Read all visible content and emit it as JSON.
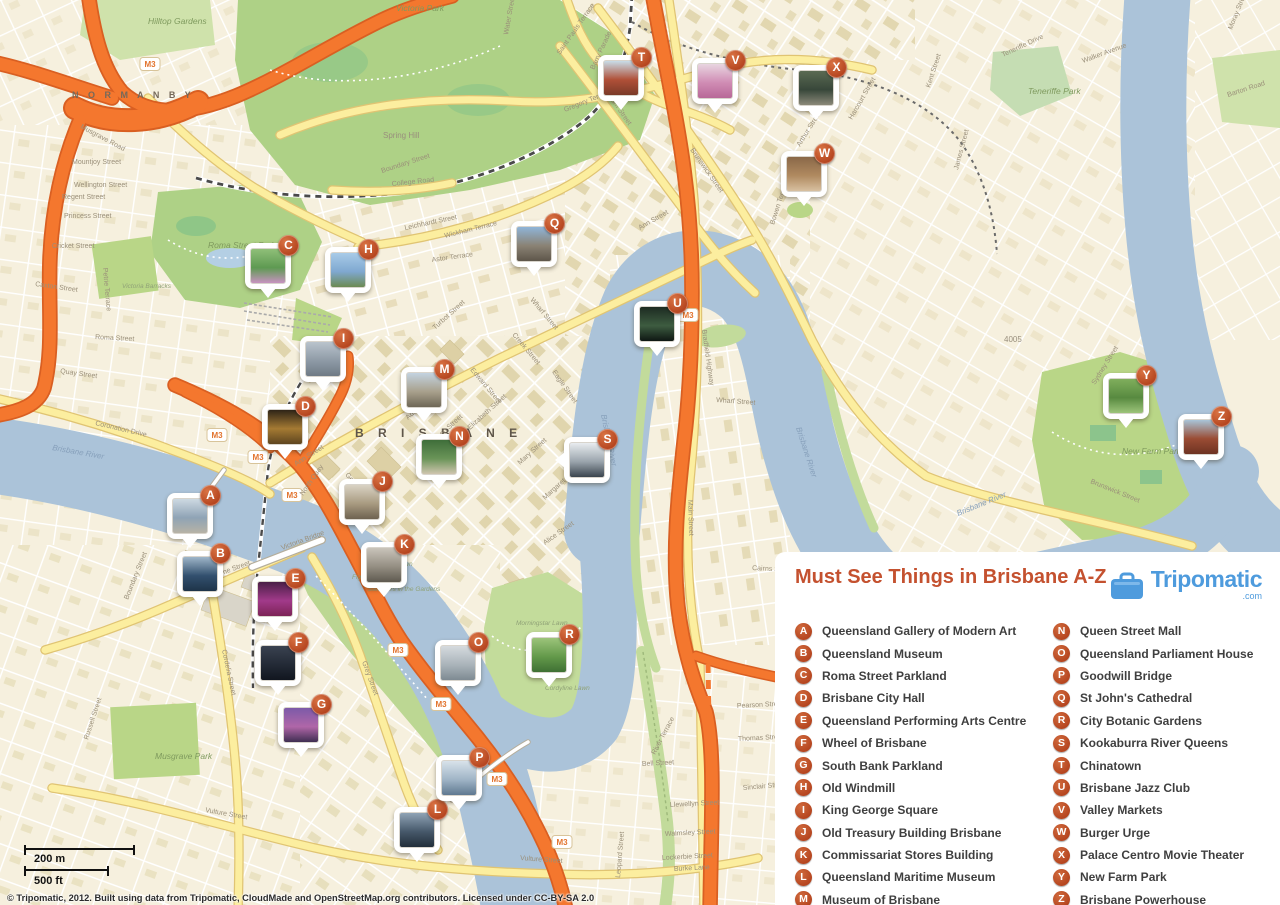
{
  "colors": {
    "water": "#abc3d9",
    "land": "#f6f0de",
    "park": "#b9d687",
    "motorway": "#f4772e",
    "road_yellow": "#fcee9f",
    "badge_orange": "#bf4f27",
    "title_orange": "#c4512f",
    "brand_blue": "#4e9bdd"
  },
  "legend": {
    "title": "Must See Things in Brisbane A-Z",
    "brand": {
      "name": "Tripomatic",
      "tld": ".com"
    },
    "items": [
      {
        "letter": "A",
        "label": "Queensland Gallery of Modern Art"
      },
      {
        "letter": "B",
        "label": "Queensland Museum"
      },
      {
        "letter": "C",
        "label": "Roma Street Parkland"
      },
      {
        "letter": "D",
        "label": "Brisbane City Hall"
      },
      {
        "letter": "E",
        "label": "Queensland Performing Arts Centre"
      },
      {
        "letter": "F",
        "label": "Wheel of Brisbane"
      },
      {
        "letter": "G",
        "label": "South Bank Parkland"
      },
      {
        "letter": "H",
        "label": "Old Windmill"
      },
      {
        "letter": "I",
        "label": "King George Square"
      },
      {
        "letter": "J",
        "label": "Old Treasury Building Brisbane"
      },
      {
        "letter": "K",
        "label": "Commissariat Stores Building"
      },
      {
        "letter": "L",
        "label": "Queensland Maritime Museum"
      },
      {
        "letter": "M",
        "label": "Museum of Brisbane"
      },
      {
        "letter": "N",
        "label": "Queen Street Mall"
      },
      {
        "letter": "O",
        "label": "Queensland Parliament House"
      },
      {
        "letter": "P",
        "label": "Goodwill Bridge"
      },
      {
        "letter": "Q",
        "label": "St John's Cathedral"
      },
      {
        "letter": "R",
        "label": "City Botanic Gardens"
      },
      {
        "letter": "S",
        "label": "Kookaburra River Queens"
      },
      {
        "letter": "T",
        "label": "Chinatown"
      },
      {
        "letter": "U",
        "label": "Brisbane Jazz Club"
      },
      {
        "letter": "V",
        "label": "Valley Markets"
      },
      {
        "letter": "W",
        "label": "Burger Urge"
      },
      {
        "letter": "X",
        "label": "Palace Centro Movie Theater"
      },
      {
        "letter": "Y",
        "label": "New Farm Park"
      },
      {
        "letter": "Z",
        "label": "Brisbane Powerhouse"
      }
    ]
  },
  "markers": [
    {
      "letter": "A",
      "x": 190,
      "y": 516,
      "tail": "b",
      "photo": [
        "#cdd9e2",
        "#8fa3b5",
        "#b7b2a6"
      ]
    },
    {
      "letter": "B",
      "x": 200,
      "y": 574,
      "tail": "b",
      "photo": [
        "#9fb6c9",
        "#32506e",
        "#1e3348"
      ]
    },
    {
      "letter": "C",
      "x": 268,
      "y": 266,
      "tail": "b",
      "photo": [
        "#8fbf78",
        "#5e9a52",
        "#c793c0"
      ]
    },
    {
      "letter": "D",
      "x": 285,
      "y": 427,
      "tail": "b",
      "photo": [
        "#2e2417",
        "#a57a33",
        "#5e451f"
      ]
    },
    {
      "letter": "E",
      "x": 275,
      "y": 599,
      "tail": "b",
      "photo": [
        "#4a1f47",
        "#a13a8a",
        "#7c2356"
      ]
    },
    {
      "letter": "F",
      "x": 278,
      "y": 663,
      "tail": "b",
      "photo": [
        "#3a4250",
        "#232a36",
        "#11161f"
      ]
    },
    {
      "letter": "G",
      "x": 301,
      "y": 725,
      "tail": "b",
      "photo": [
        "#7c5aa8",
        "#b066a8",
        "#3f2e52"
      ]
    },
    {
      "letter": "H",
      "x": 348,
      "y": 270,
      "tail": "b",
      "photo": [
        "#a8cbe8",
        "#7fa8d0",
        "#6c8a52"
      ]
    },
    {
      "letter": "I",
      "x": 323,
      "y": 359,
      "tail": "b",
      "photo": [
        "#b9c3cc",
        "#8e9aa6",
        "#6f7a85"
      ]
    },
    {
      "letter": "J",
      "x": 362,
      "y": 502,
      "tail": "b",
      "photo": [
        "#d9d2c4",
        "#a89a80",
        "#6e6250"
      ]
    },
    {
      "letter": "K",
      "x": 384,
      "y": 565,
      "tail": "b",
      "photo": [
        "#c9c4ba",
        "#948e82",
        "#5f5a50"
      ]
    },
    {
      "letter": "L",
      "x": 417,
      "y": 830,
      "tail": "b",
      "photo": [
        "#8fa3b5",
        "#46586a",
        "#222e3a"
      ]
    },
    {
      "letter": "M",
      "x": 424,
      "y": 390,
      "tail": "b",
      "photo": [
        "#c3d2e0",
        "#a8a08c",
        "#6e6756"
      ]
    },
    {
      "letter": "N",
      "x": 439,
      "y": 457,
      "tail": "b",
      "photo": [
        "#3f6e3a",
        "#6a9458",
        "#cfc5ae"
      ]
    },
    {
      "letter": "O",
      "x": 458,
      "y": 663,
      "tail": "b",
      "photo": [
        "#d5dade",
        "#aab4ba",
        "#7e8a92"
      ]
    },
    {
      "letter": "P",
      "x": 459,
      "y": 778,
      "tail": "b",
      "photo": [
        "#d8e2ea",
        "#9fb4c6",
        "#5f7890"
      ]
    },
    {
      "letter": "Q",
      "x": 534,
      "y": 244,
      "tail": "b",
      "photo": [
        "#8fb4d8",
        "#8a8274",
        "#5e564a"
      ]
    },
    {
      "letter": "R",
      "x": 549,
      "y": 655,
      "tail": "b",
      "photo": [
        "#9cc47a",
        "#63994a",
        "#3f7034"
      ]
    },
    {
      "letter": "S",
      "x": 587,
      "y": 460,
      "tail": "l",
      "photo": [
        "#e8ecef",
        "#9aa4ac",
        "#3a444e"
      ]
    },
    {
      "letter": "T",
      "x": 621,
      "y": 78,
      "tail": "b",
      "photo": [
        "#c8dce8",
        "#b05038",
        "#7a3a28"
      ]
    },
    {
      "letter": "U",
      "x": 657,
      "y": 324,
      "tail": "b",
      "photo": [
        "#1d2b22",
        "#3d5c40",
        "#0e1713"
      ]
    },
    {
      "letter": "V",
      "x": 715,
      "y": 81,
      "tail": "b",
      "photo": [
        "#e8d5e0",
        "#d08cb4",
        "#b86898"
      ]
    },
    {
      "letter": "W",
      "x": 804,
      "y": 174,
      "tail": "b",
      "photo": [
        "#8a6848",
        "#b08a60",
        "#d8c0a0"
      ]
    },
    {
      "letter": "X",
      "x": 816,
      "y": 88,
      "tail": "b",
      "photo": [
        "#5a6a52",
        "#38473a",
        "#8a8878"
      ]
    },
    {
      "letter": "Y",
      "x": 1126,
      "y": 396,
      "tail": "b",
      "photo": [
        "#7fae5c",
        "#588a40",
        "#9cc47a"
      ]
    },
    {
      "letter": "Z",
      "x": 1201,
      "y": 437,
      "tail": "b",
      "photo": [
        "#a8c4d8",
        "#9a4c34",
        "#6e3322"
      ]
    }
  ],
  "map_labels": {
    "places": [
      {
        "t": "N O R M A N B Y",
        "x": 72,
        "y": 98,
        "cls": "lbl-suburb"
      },
      {
        "t": "B R I S B A N E",
        "x": 355,
        "y": 437,
        "cls": "lbl-suburb-lg"
      },
      {
        "t": "Spring Hill",
        "x": 383,
        "y": 138,
        "cls": "lbl-suburb-sm"
      },
      {
        "t": "4005",
        "x": 1004,
        "y": 342,
        "cls": "lbl-suburb-sm"
      },
      {
        "t": "Victoria Park",
        "x": 396,
        "y": 11,
        "cls": "lbl-park"
      },
      {
        "t": "Hilltop Gardens",
        "x": 148,
        "y": 24,
        "cls": "lbl-park"
      },
      {
        "t": "Roma Street Park",
        "x": 208,
        "y": 248,
        "cls": "lbl-park"
      },
      {
        "t": "Victoria Barracks",
        "x": 122,
        "y": 288,
        "cls": "lbl-park-sm"
      },
      {
        "t": "Musgrave Park",
        "x": 155,
        "y": 759,
        "cls": "lbl-park"
      },
      {
        "t": "New Farm Park",
        "x": 1122,
        "y": 454,
        "cls": "lbl-park"
      },
      {
        "t": "Teneriffe Park",
        "x": 1028,
        "y": 94,
        "cls": "lbl-park"
      },
      {
        "t": "Royal Palm Lawn",
        "x": 362,
        "y": 566,
        "cls": "lbl-park-sm"
      },
      {
        "t": "Fig Tree Avenue",
        "x": 352,
        "y": 579,
        "cls": "lbl-park-sm"
      },
      {
        "t": "Steamers in the Gardens",
        "x": 368,
        "y": 591,
        "cls": "lbl-park-sm"
      },
      {
        "t": "Morningstar Lawn",
        "x": 516,
        "y": 625,
        "cls": "lbl-park-sm"
      },
      {
        "t": "Cordyline Lawn",
        "x": 545,
        "y": 690,
        "cls": "lbl-park-sm"
      }
    ],
    "rivers": [
      {
        "t": "Brisbane River",
        "x": 52,
        "y": 450,
        "rot": 10
      },
      {
        "t": "Brisbane River",
        "x": 601,
        "y": 415,
        "rot": 78
      },
      {
        "t": "Brisbane River",
        "x": 796,
        "y": 428,
        "rot": 72
      },
      {
        "t": "Brisbane River",
        "x": 958,
        "y": 516,
        "rot": -22
      }
    ],
    "streets": [
      {
        "t": "Gregory Terrace",
        "x": 565,
        "y": 112,
        "rot": -22
      },
      {
        "t": "College Road",
        "x": 392,
        "y": 186,
        "rot": -6
      },
      {
        "t": "Wickham Terrace",
        "x": 445,
        "y": 238,
        "rot": -14
      },
      {
        "t": "Boundary Street",
        "x": 382,
        "y": 173,
        "rot": -18
      },
      {
        "t": "Leichhardt Street",
        "x": 405,
        "y": 230,
        "rot": -12
      },
      {
        "t": "Astor Terrace",
        "x": 432,
        "y": 262,
        "rot": -8
      },
      {
        "t": "Turbot Street",
        "x": 435,
        "y": 330,
        "rot": -42
      },
      {
        "t": "Ann Street",
        "x": 296,
        "y": 466,
        "rot": -32
      },
      {
        "t": "Ann Street",
        "x": 640,
        "y": 230,
        "rot": -30
      },
      {
        "t": "North Quay",
        "x": 303,
        "y": 496,
        "rot": -55
      },
      {
        "t": "Adelaide Street",
        "x": 408,
        "y": 420,
        "rot": -42
      },
      {
        "t": "Queen Street",
        "x": 432,
        "y": 445,
        "rot": -42
      },
      {
        "t": "Elizabeth Street",
        "x": 470,
        "y": 430,
        "rot": -42
      },
      {
        "t": "Mary Street",
        "x": 520,
        "y": 465,
        "rot": -42
      },
      {
        "t": "Margaret Street",
        "x": 545,
        "y": 500,
        "rot": -42
      },
      {
        "t": "Alice Street",
        "x": 545,
        "y": 545,
        "rot": -35
      },
      {
        "t": "George Street",
        "x": 345,
        "y": 475,
        "rot": 50
      },
      {
        "t": "Edward Street",
        "x": 470,
        "y": 370,
        "rot": 50
      },
      {
        "t": "Creek Street",
        "x": 512,
        "y": 335,
        "rot": 50
      },
      {
        "t": "Wharf Street",
        "x": 530,
        "y": 300,
        "rot": 50
      },
      {
        "t": "Eagle Street",
        "x": 552,
        "y": 372,
        "rot": 55
      },
      {
        "t": "Roma Street",
        "x": 95,
        "y": 339,
        "rot": 3
      },
      {
        "t": "Quay Street",
        "x": 60,
        "y": 373,
        "rot": 8
      },
      {
        "t": "Coronation Drive",
        "x": 95,
        "y": 425,
        "rot": 13
      },
      {
        "t": "Melbourne Street",
        "x": 200,
        "y": 583,
        "rot": -20
      },
      {
        "t": "Grey Street",
        "x": 362,
        "y": 662,
        "rot": 70
      },
      {
        "t": "Cordelia Street",
        "x": 222,
        "y": 650,
        "rot": 78
      },
      {
        "t": "Vulture Street",
        "x": 205,
        "y": 812,
        "rot": 10
      },
      {
        "t": "Vulture Street",
        "x": 520,
        "y": 860,
        "rot": 4
      },
      {
        "t": "Boundary Street",
        "x": 128,
        "y": 600,
        "rot": -68
      },
      {
        "t": "Russell Street",
        "x": 88,
        "y": 740,
        "rot": -72
      },
      {
        "t": "Main Street",
        "x": 688,
        "y": 500,
        "rot": 88
      },
      {
        "t": "Bradfield Highway",
        "x": 702,
        "y": 330,
        "rot": 82
      },
      {
        "t": "Wharf Street",
        "x": 716,
        "y": 402,
        "rot": 4
      },
      {
        "t": "Brunswick Street",
        "x": 690,
        "y": 150,
        "rot": 55
      },
      {
        "t": "Brunswick Street",
        "x": 1090,
        "y": 483,
        "rot": 22
      },
      {
        "t": "Wickham Street",
        "x": 600,
        "y": 85,
        "rot": 55
      },
      {
        "t": "Saint Pauls Terrace",
        "x": 560,
        "y": 55,
        "rot": -55
      },
      {
        "t": "Barry Parade",
        "x": 594,
        "y": 70,
        "rot": -65
      },
      {
        "t": "Water Street",
        "x": 508,
        "y": 35,
        "rot": -80
      },
      {
        "t": "Arthur Street",
        "x": 800,
        "y": 147,
        "rot": -58
      },
      {
        "t": "Harcourt Street",
        "x": 852,
        "y": 120,
        "rot": -60
      },
      {
        "t": "Kent Street",
        "x": 930,
        "y": 88,
        "rot": -72
      },
      {
        "t": "James Street",
        "x": 958,
        "y": 170,
        "rot": -75
      },
      {
        "t": "Sydney Street",
        "x": 1095,
        "y": 385,
        "rot": -58
      },
      {
        "t": "Moray Street",
        "x": 1232,
        "y": 30,
        "rot": -68
      },
      {
        "t": "Barton Road",
        "x": 1228,
        "y": 97,
        "rot": -18
      },
      {
        "t": "Walker Avenue",
        "x": 1083,
        "y": 63,
        "rot": -20
      },
      {
        "t": "Teneriffe Drive",
        "x": 1003,
        "y": 57,
        "rot": -25
      },
      {
        "t": "Bowen Terrace",
        "x": 774,
        "y": 225,
        "rot": -72
      },
      {
        "t": "River Terrace",
        "x": 655,
        "y": 755,
        "rot": -62
      },
      {
        "t": "Pearson Street",
        "x": 737,
        "y": 708,
        "rot": -3
      },
      {
        "t": "Thomas Street",
        "x": 738,
        "y": 741,
        "rot": -3
      },
      {
        "t": "Bell Street",
        "x": 642,
        "y": 766,
        "rot": -3
      },
      {
        "t": "Sinclair Street",
        "x": 743,
        "y": 790,
        "rot": -5
      },
      {
        "t": "Llewellyn Street",
        "x": 670,
        "y": 807,
        "rot": -3
      },
      {
        "t": "Walmsley Street",
        "x": 665,
        "y": 836,
        "rot": -3
      },
      {
        "t": "Lockerbie Street",
        "x": 662,
        "y": 860,
        "rot": -3
      },
      {
        "t": "Burke Lane",
        "x": 674,
        "y": 871,
        "rot": -3
      },
      {
        "t": "Leopard Street",
        "x": 620,
        "y": 878,
        "rot": -85
      },
      {
        "t": "Mountjoy Street",
        "x": 72,
        "y": 164,
        "rot": 0
      },
      {
        "t": "Wellington Street",
        "x": 74,
        "y": 187,
        "rot": 0
      },
      {
        "t": "Regent Street",
        "x": 62,
        "y": 199,
        "rot": 0
      },
      {
        "t": "Princess Street",
        "x": 64,
        "y": 218,
        "rot": 0
      },
      {
        "t": "Cricket Street",
        "x": 52,
        "y": 248,
        "rot": 0
      },
      {
        "t": "Caxton Street",
        "x": 35,
        "y": 286,
        "rot": 8
      },
      {
        "t": "Musgrave Road",
        "x": 80,
        "y": 128,
        "rot": 28
      },
      {
        "t": "Petrie Terrace",
        "x": 103,
        "y": 268,
        "rot": 85
      },
      {
        "t": "Victoria Bridge",
        "x": 282,
        "y": 550,
        "rot": -20
      },
      {
        "t": "Cairns Street",
        "x": 752,
        "y": 570,
        "rot": 3
      }
    ]
  },
  "shields": [
    {
      "text": "M3",
      "x": 150,
      "y": 64
    },
    {
      "text": "M3",
      "x": 217,
      "y": 435
    },
    {
      "text": "M3",
      "x": 258,
      "y": 457
    },
    {
      "text": "M3",
      "x": 292,
      "y": 495
    },
    {
      "text": "M3",
      "x": 398,
      "y": 650
    },
    {
      "text": "M3",
      "x": 441,
      "y": 704
    },
    {
      "text": "M3",
      "x": 497,
      "y": 779
    },
    {
      "text": "M3",
      "x": 688,
      "y": 315
    },
    {
      "text": "M3",
      "x": 562,
      "y": 842
    }
  ],
  "scale_bar": {
    "metric": "200 m",
    "imperial": "500 ft"
  },
  "copyright": "© Tripomatic, 2012. Built using data from Tripomatic, CloudMade and OpenStreetMap.org contributors. Licensed under CC-BY-SA 2.0"
}
